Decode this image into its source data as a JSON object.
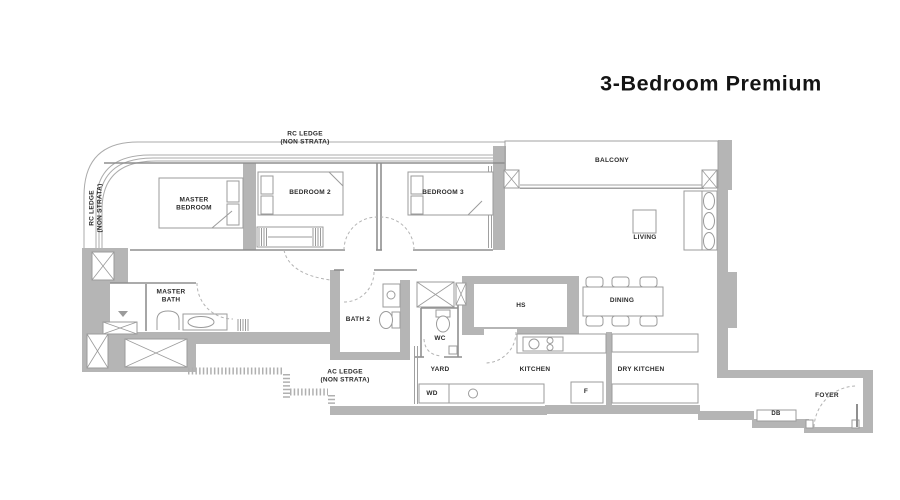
{
  "title": "3-Bedroom Premium",
  "labels": {
    "rc_ledge_top": "RC LEDGE\n(NON STRATA)",
    "rc_ledge_left": "RC LEDGE\n(NON STRATA)",
    "ac_ledge": "AC LEDGE\n(NON STRATA)",
    "master_bedroom": "MASTER\nBEDROOM",
    "bedroom2": "BEDROOM 2",
    "bedroom3": "BEDROOM 3",
    "balcony": "BALCONY",
    "living": "LIVING",
    "dining": "DINING",
    "master_bath": "MASTER\nBATH",
    "bath2": "BATH 2",
    "wc": "WC",
    "hs": "HS",
    "yard": "YARD",
    "kitchen": "KITCHEN",
    "dry_kitchen": "DRY KITCHEN",
    "wd": "WD",
    "fridge": "F",
    "foyer": "FOYER",
    "db": "DB"
  },
  "colors": {
    "wall": "#b5b5b5",
    "line": "#9b9b9b",
    "ledge_line": "#ababab",
    "text": "#2b2b2b"
  }
}
